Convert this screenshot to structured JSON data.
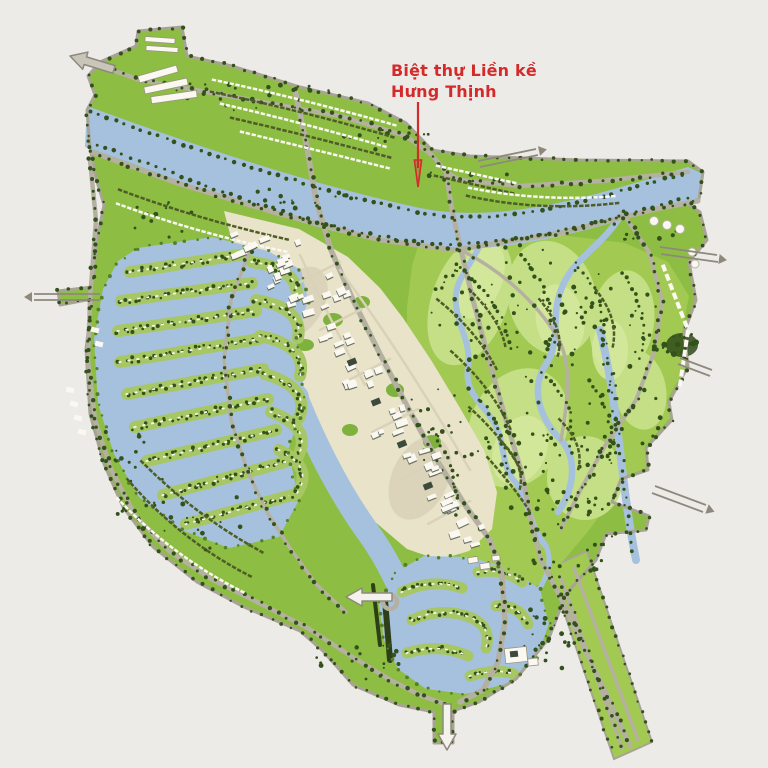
{
  "annotation": {
    "line1": "Biệt thự Liền kề",
    "line2": "Hưng Thịnh"
  },
  "icons": {
    "annotation_pointer": "red-down-arrow-line",
    "exit_arrow_top_left": "outline-arrow",
    "exit_arrow_west": "outline-arrow",
    "exit_arrow_south": "outline-arrow"
  },
  "colors": {
    "background": "#ecebe8",
    "land_green": "#8dbe43",
    "golf_green": "#a2ca52",
    "fairway_green": "#c4df85",
    "fairway_light": "#d6e99e",
    "water_blue": "#a6c1de",
    "road_gray": "#b5b0a2",
    "road_dark": "#8e897c",
    "edge_gray": "#a9a396",
    "urban_cream": "#e9e3ca",
    "urban_street": "#d9d2b8",
    "building_white": "#faf8f1",
    "building_dark": "#3c4a3c",
    "tree_dark": "#33511a",
    "tree_mid": "#567f28",
    "finger_green": "#a6c764",
    "row_olive": "#4e5c26",
    "label_red": "#d32b2b"
  }
}
